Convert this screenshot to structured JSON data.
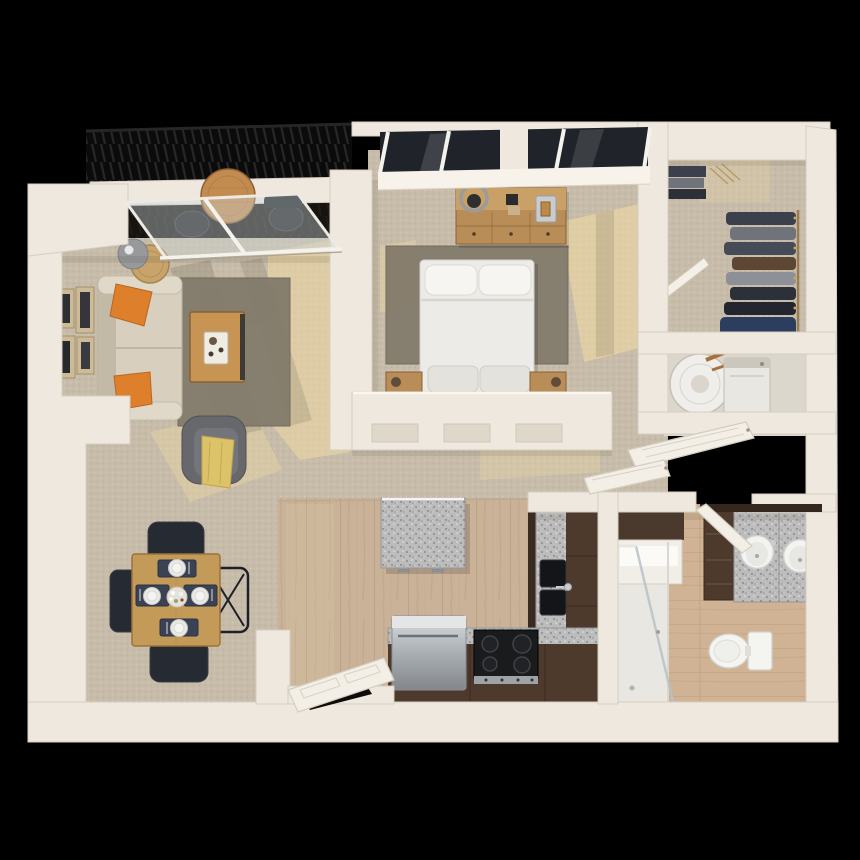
{
  "scene": {
    "kind": "3d-floor-plan-rendering",
    "view": "top-down",
    "layout": "one-bedroom-one-bath-apartment-with-balcony",
    "rooms": [
      {
        "name": "balcony",
        "items": [
          "black-metal-railing",
          "round-bistro-table",
          "two-outdoor-chairs",
          "sliding-glass-door"
        ]
      },
      {
        "name": "living-room",
        "items": [
          "sofa",
          "two-orange-accent-pillows",
          "floor-lamp",
          "round-side-table",
          "four-wall-frames",
          "gray-area-rug",
          "wood-coffee-table-with-tray",
          "gray-armchair",
          "yellow-throw-blanket"
        ]
      },
      {
        "name": "dining-area",
        "items": [
          "square-wood-table",
          "four-dark-chairs",
          "four-place-settings",
          "flower-centerpiece"
        ]
      },
      {
        "name": "kitchen",
        "items": [
          "granite-island",
          "l-shaped-brown-cabinets",
          "granite-counters",
          "black-double-sink",
          "black-cooktop-range",
          "stainless-dishwasher",
          "open-pantry-door"
        ]
      },
      {
        "name": "bedroom",
        "items": [
          "queen-bed-white-bedding",
          "two-pillows",
          "gray-area-rug",
          "wood-dresser",
          "ring-lamp",
          "two-nightstands",
          "window-wall"
        ]
      },
      {
        "name": "walk-in-closet",
        "items": [
          "hanging-clothes",
          "folded-clothes-stack",
          "closet-door-ajar"
        ]
      },
      {
        "name": "utility-closet",
        "items": [
          "water-heater-with-copper-pipes",
          "washer",
          "two-louvered-doors-open"
        ]
      },
      {
        "name": "bathroom",
        "items": [
          "double-sink-granite-vanity",
          "dark-vanity-cabinet",
          "mirror",
          "toilet",
          "glass-shower",
          "linen-shelf",
          "open-door"
        ]
      }
    ]
  },
  "colors": {
    "background": "#000000",
    "wall": "#efe8df",
    "wallBright": "#faf6ee",
    "wallShadow": "#dfd8ca",
    "wallEdge": "#d6cec0",
    "carpet": "#c7bca9",
    "carpetDot": "#b9ad98",
    "carpetDot2": "#d4cab7",
    "sunlight": "#eed9a4",
    "shadowTint": "#55503f",
    "rug": "#847c6c",
    "sofa": "#d8cfbe",
    "sofaShade": "#c3b9a7",
    "pillow": "#dd7f2b",
    "armchair": "#67686b",
    "throw": "#dcc268",
    "woodTable": "#c49a58",
    "woodTableEdge": "#9c7238",
    "chair": "#262a33",
    "placemat": "#3a4254",
    "plate": "#e9e9e6",
    "kitchenFloor": "#c9b297",
    "kitchenFloorLine": "#a8906f",
    "bathFloor": "#cfb394",
    "bathFloorLine": "#b3946f",
    "cabinet": "#4e3a2d",
    "cabinetDark": "#3a2b21",
    "granite": "#bcbcbc",
    "graniteDot": "#8c8c8c",
    "stainless": "#a9afb4",
    "stove": "#1a1b1d",
    "fixture": "#f4f4f1",
    "windowGlass": "#20242a",
    "windowFrame": "#f4f2ec",
    "balconyFloor": "#17140f",
    "railing": "#0b0b0b",
    "railingSlat": "#2a2a2a",
    "glass": "#cdd8da",
    "copper": "#a96f3f",
    "bed": "#ecebe7",
    "dresser": "#b98d58",
    "utilityFloor": "#dcd7cd",
    "clothes1": "#3b404c",
    "clothes2": "#70747a",
    "clothes3": "#5d4634",
    "clothes4": "#2c3e5e"
  }
}
